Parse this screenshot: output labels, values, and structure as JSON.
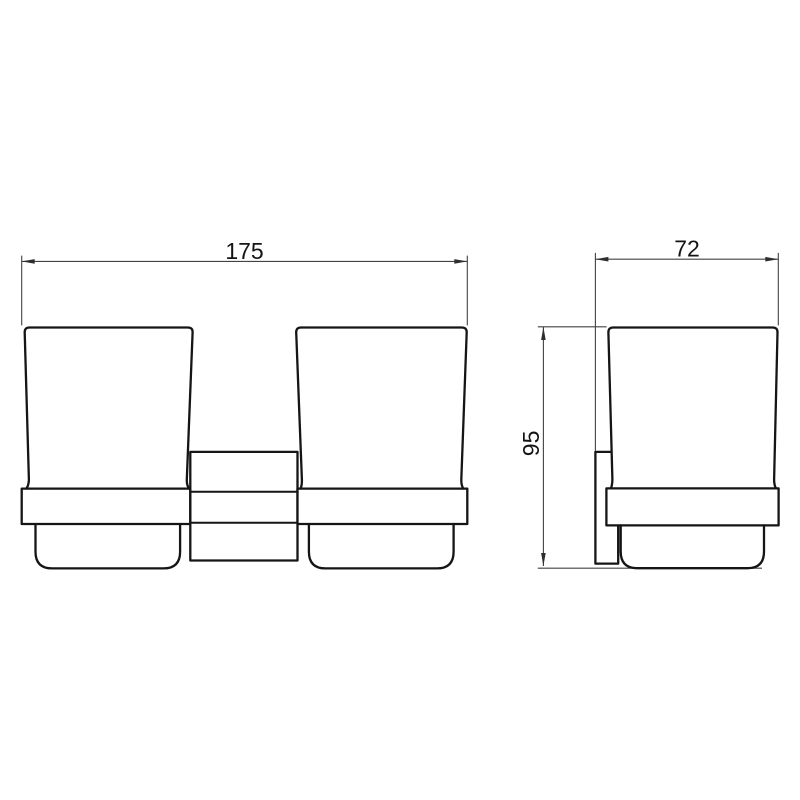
{
  "page": {
    "background": "#ffffff"
  },
  "drawing": {
    "subject": "wall-mounted-double-tumbler-holder",
    "colors": {
      "outline": "#151515",
      "dimension_lines": "#424242",
      "text": "#141414",
      "background": "#ffffff"
    },
    "views": {
      "front": {
        "dimensions": {
          "overall_width": "175"
        }
      },
      "side": {
        "dimensions": {
          "overall_depth": "72",
          "overall_height": "95"
        }
      }
    }
  }
}
